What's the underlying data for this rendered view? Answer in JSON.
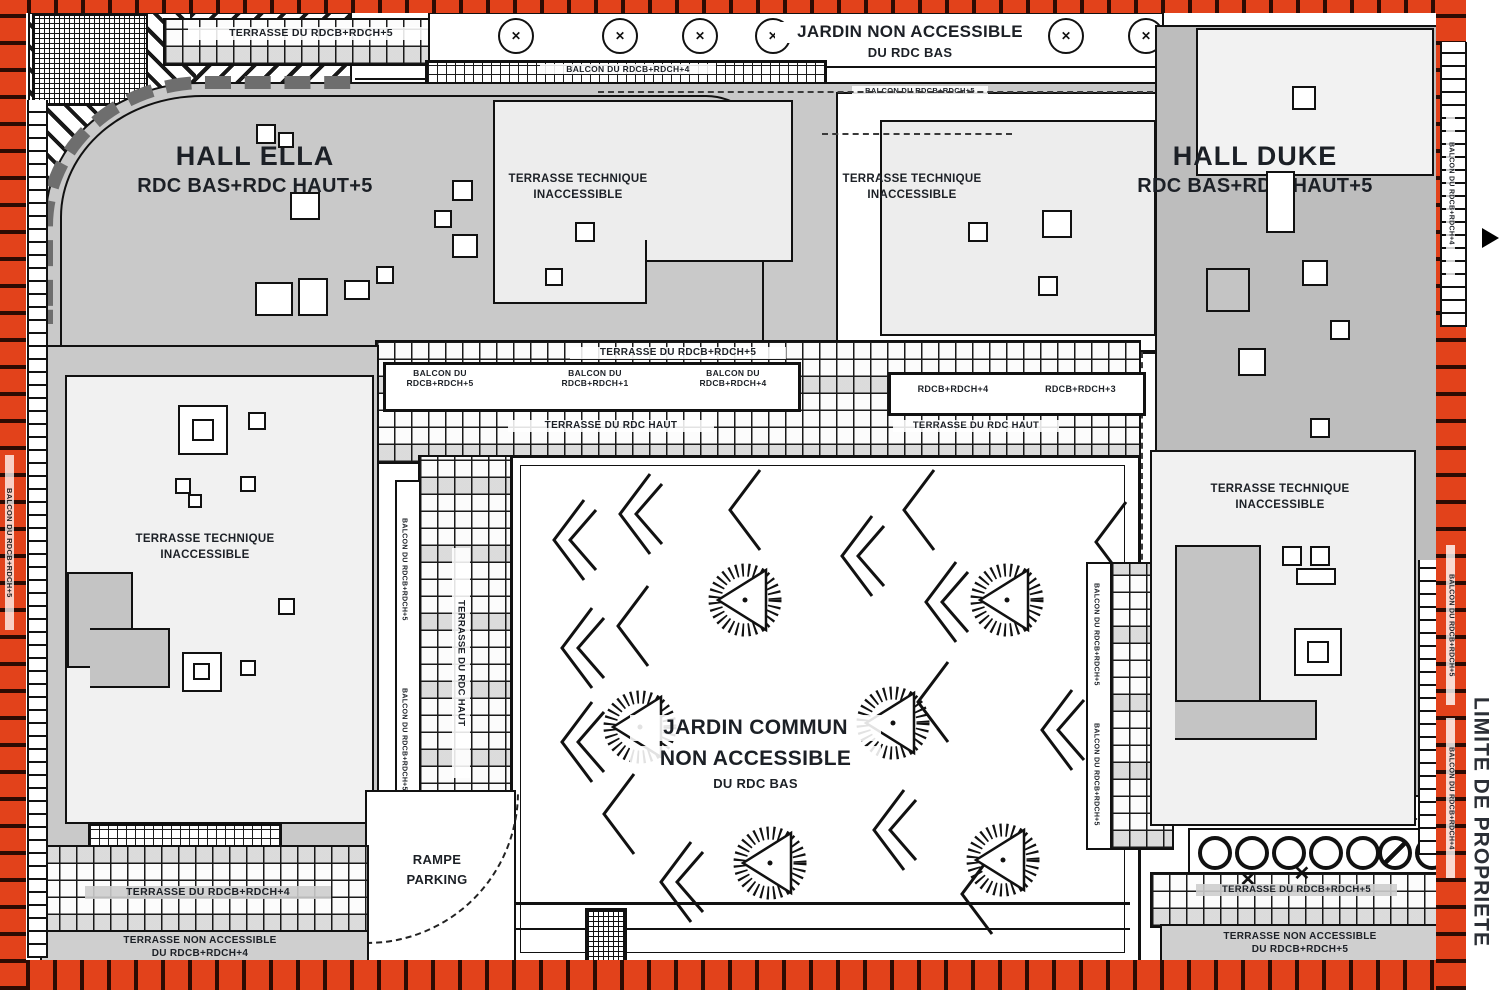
{
  "halls": {
    "ella": {
      "name": "HALL ELLA",
      "levels": "RDC BAS+RDC HAUT+5"
    },
    "duke": {
      "name": "HALL DUKE",
      "levels": "RDC BAS+RDC HAUT+5"
    }
  },
  "jardin_top": {
    "line1": "JARDIN NON ACCESSIBLE",
    "line2": "DU RDC BAS"
  },
  "jardin_commun": {
    "line1": "JARDIN COMMUN",
    "line2": "NON ACCESSIBLE",
    "line3": "DU RDC BAS"
  },
  "terrasse_technique": {
    "line1": "TERRASSE TECHNIQUE",
    "line2": "INACCESSIBLE"
  },
  "rampe": {
    "line1": "RAMPE",
    "line2": "PARKING"
  },
  "strips": {
    "terrasse_top": "TERRASSE DU RDCB+RDCH+5",
    "balcon_top": "BALCON DU RDCB+RDCH+4",
    "balcon_top_right": "BALCON DU RDCB+RDCH+5",
    "terrasse_mid": "TERRASSE DU RDCB+RDCH+5",
    "balcon_5_l1": "BALCON DU",
    "balcon_5_l2": "RDCB+RDCH+5",
    "balcon_1_l1": "BALCON DU",
    "balcon_1_l2": "RDCB+RDCH+1",
    "balcon_4_l1": "BALCON DU",
    "balcon_4_l2": "RDCB+RDCH+4",
    "rdcb4": "RDCB+RDCH+4",
    "rdcb3": "RDCB+RDCH+3",
    "terrasse_rdc_haut": "TERRASSE DU RDC HAUT",
    "terrasse_bottom_left": "TERRASSE DU RDCB+RDCH+4",
    "terrasse_bottom_right": "TERRASSE DU RDCB+RDCH+5"
  },
  "bands": {
    "bottom_left_l1": "TERRASSE NON ACCESSIBLE",
    "bottom_left_l2": "DU RDCB+RDCH+4",
    "bottom_right_l1": "TERRASSE NON ACCESSIBLE",
    "bottom_right_l2": "DU RDCB+RDCH+5"
  },
  "edge": {
    "limite": "LIMITE DE PROPRIETE",
    "balcon_left_v": "BALCON DU RDCB+RDCH+5",
    "balcon_right_v1": "BALCON DU RDCB+RDCH+4",
    "balcon_right_v2": "BALCON DU RDCB+RDCH+5",
    "balcon_right_v3": "BALCON DU RDCB+RDCH+4",
    "balcon_mid_v1": "BALCON DU RDCB+RDCH+5",
    "balcon_mid_v2": "BALCON DU RDCB+RDCH+5",
    "terrasse_v": "TERRASSE DU RDC HAUT"
  },
  "icons": {
    "tree_cross": "✕"
  },
  "colors": {
    "border_red": "#e2421b",
    "building_gray": "#c9c9c9",
    "building_gray_dark": "#bdbdbd",
    "panel": "#ededed",
    "line": "#141414"
  }
}
